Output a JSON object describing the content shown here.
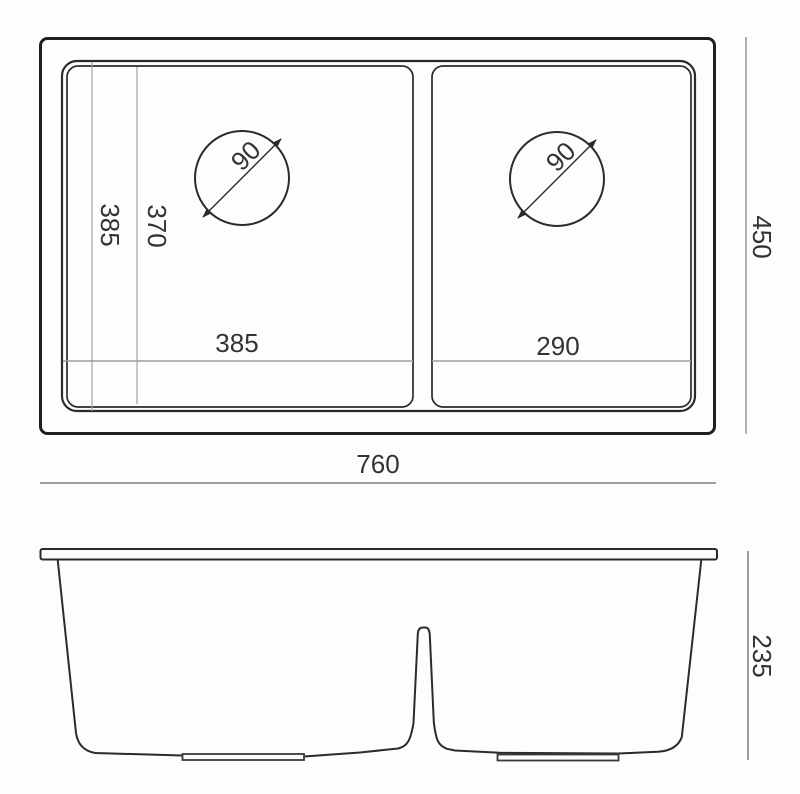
{
  "title": "Double bowl undermount sink dimension drawing",
  "top_view": {
    "overall_width": "760",
    "overall_depth": "450",
    "bowl_depth_outer": "385",
    "bowl_depth_inner": "370",
    "left_bowl_width": "385",
    "right_bowl_width": "290",
    "left_drain_diameter": "90",
    "right_drain_diameter": "90"
  },
  "side_view": {
    "height": "235"
  },
  "colors": {
    "line": "#2b2b2b",
    "outer_line": "#1f1f1f",
    "dim_line": "#9e9e9e",
    "text": "#333333",
    "background": "#fdfdfd"
  }
}
